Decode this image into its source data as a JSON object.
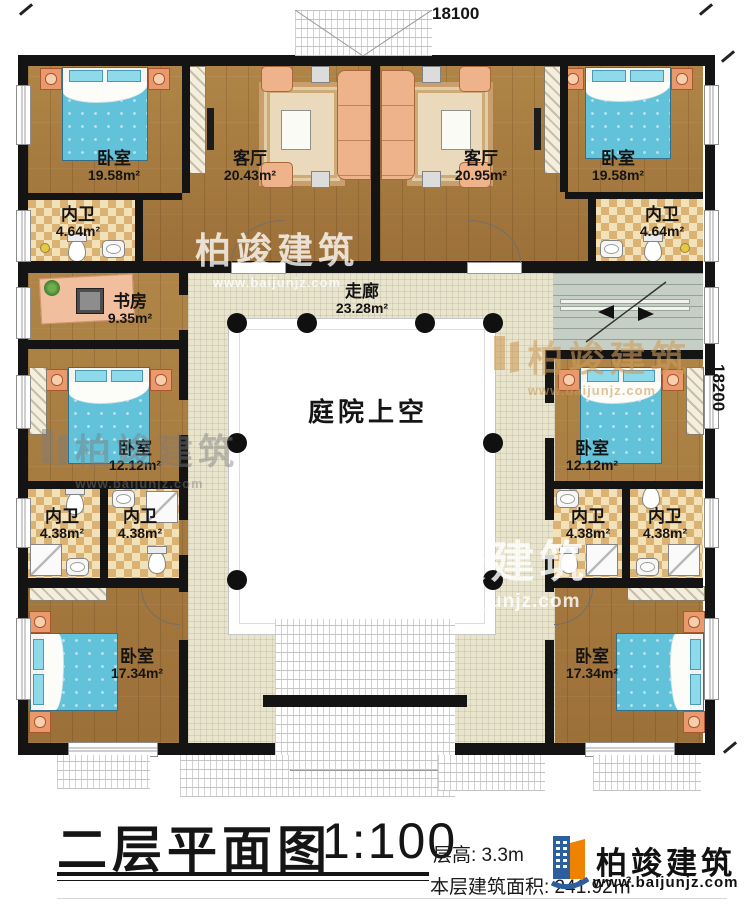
{
  "plan": {
    "dimensions": {
      "top": "18100",
      "right": "18200"
    },
    "rooms": [
      {
        "id": "bedroom-top-left",
        "name": "卧室",
        "area": "19.58m²"
      },
      {
        "id": "bath-top-left",
        "name": "内卫",
        "area": "4.64m²"
      },
      {
        "id": "living-left",
        "name": "客厅",
        "area": "20.43m²"
      },
      {
        "id": "living-right",
        "name": "客厅",
        "area": "20.95m²"
      },
      {
        "id": "bedroom-top-right",
        "name": "卧室",
        "area": "19.58m²"
      },
      {
        "id": "bath-top-right",
        "name": "内卫",
        "area": "4.64m²"
      },
      {
        "id": "study",
        "name": "书房",
        "area": "9.35m²"
      },
      {
        "id": "corridor",
        "name": "走廊",
        "area": "23.28m²"
      },
      {
        "id": "courtyard",
        "name": "庭院上空",
        "area": ""
      },
      {
        "id": "bedroom-mid-left",
        "name": "卧室",
        "area": "12.12m²"
      },
      {
        "id": "bath-mid-left-1",
        "name": "内卫",
        "area": "4.38m²"
      },
      {
        "id": "bath-mid-left-2",
        "name": "内卫",
        "area": "4.38m²"
      },
      {
        "id": "bedroom-mid-right",
        "name": "卧室",
        "area": "12.12m²"
      },
      {
        "id": "bath-mid-right-1",
        "name": "内卫",
        "area": "4.38m²"
      },
      {
        "id": "bath-mid-right-2",
        "name": "内卫",
        "area": "4.38m²"
      },
      {
        "id": "bedroom-bottom-left",
        "name": "卧室",
        "area": "17.34m²"
      },
      {
        "id": "bedroom-bottom-right",
        "name": "卧室",
        "area": "17.34m²"
      }
    ]
  },
  "watermark": {
    "brand": "柏竣建筑",
    "url": "www.baijunjz.com"
  },
  "title": {
    "text": "二层平面图",
    "scale": "1:100",
    "floor_height": "层高: 3.3m",
    "floor_area": "本层建筑面积: 241.92㎡"
  },
  "brand": {
    "name": "柏竣建筑",
    "url": "www.baijunjz.com",
    "blue": "#2b5f9e",
    "orange": "#ef8200"
  }
}
